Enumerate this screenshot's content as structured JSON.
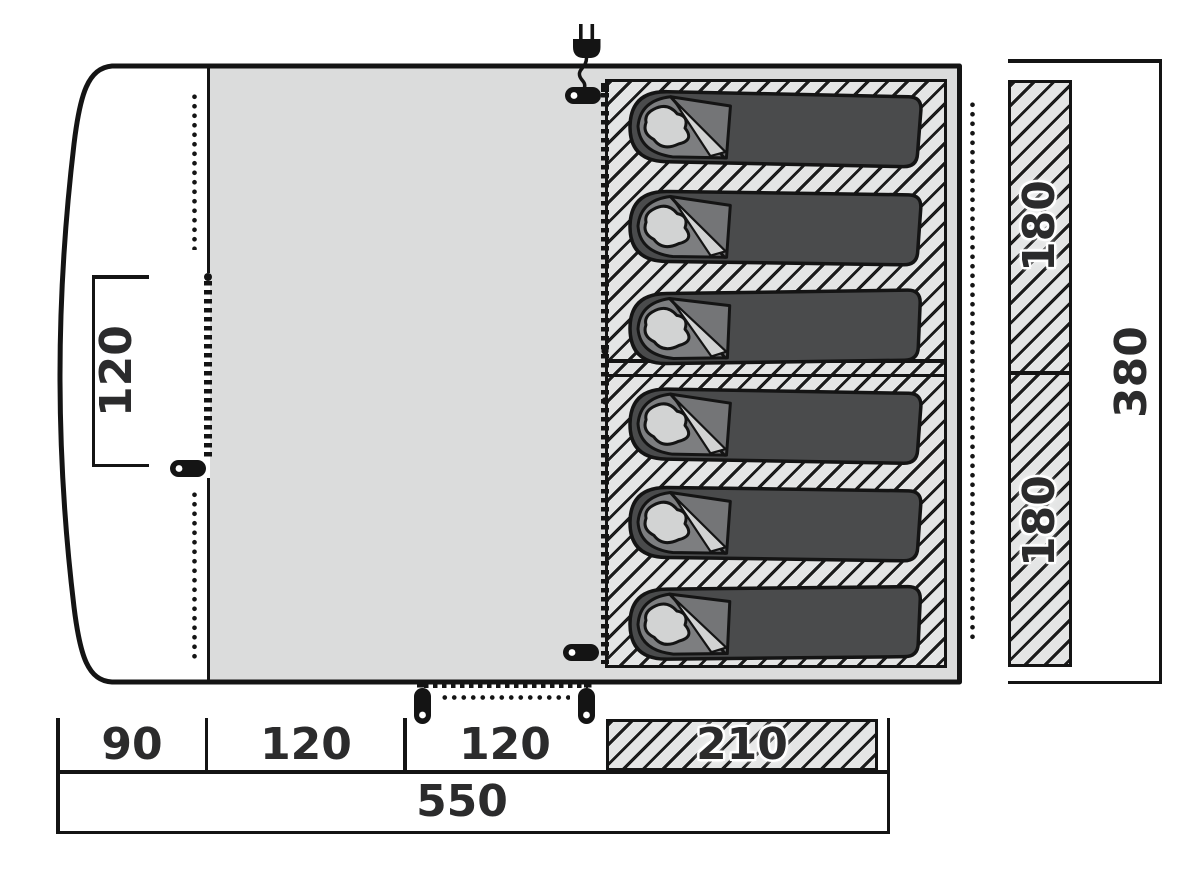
{
  "diagram": {
    "type": "tent-floorplan",
    "unit": "cm",
    "dims": {
      "porch_opening": "120",
      "bedroom_upper": "180",
      "bedroom_lower": "180",
      "depth_total": "380",
      "floor_segments": [
        "90",
        "120",
        "120",
        "210"
      ],
      "width_total": "550"
    },
    "features": {
      "sleeping_bag_count": 6,
      "icons": [
        "power-plug-icon",
        "zipper-pull-icon",
        "zipper-seam",
        "dotted-seam"
      ]
    },
    "colors": {
      "outline": "#141414",
      "living_floor": "#dbdcdc",
      "hatch_background": "#e4e5e5",
      "bag_body": "#4a4b4c",
      "bag_lining": "#7d7e80",
      "bag_pillow": "#d2d3d3",
      "label_text": "#2b2b2c"
    }
  }
}
